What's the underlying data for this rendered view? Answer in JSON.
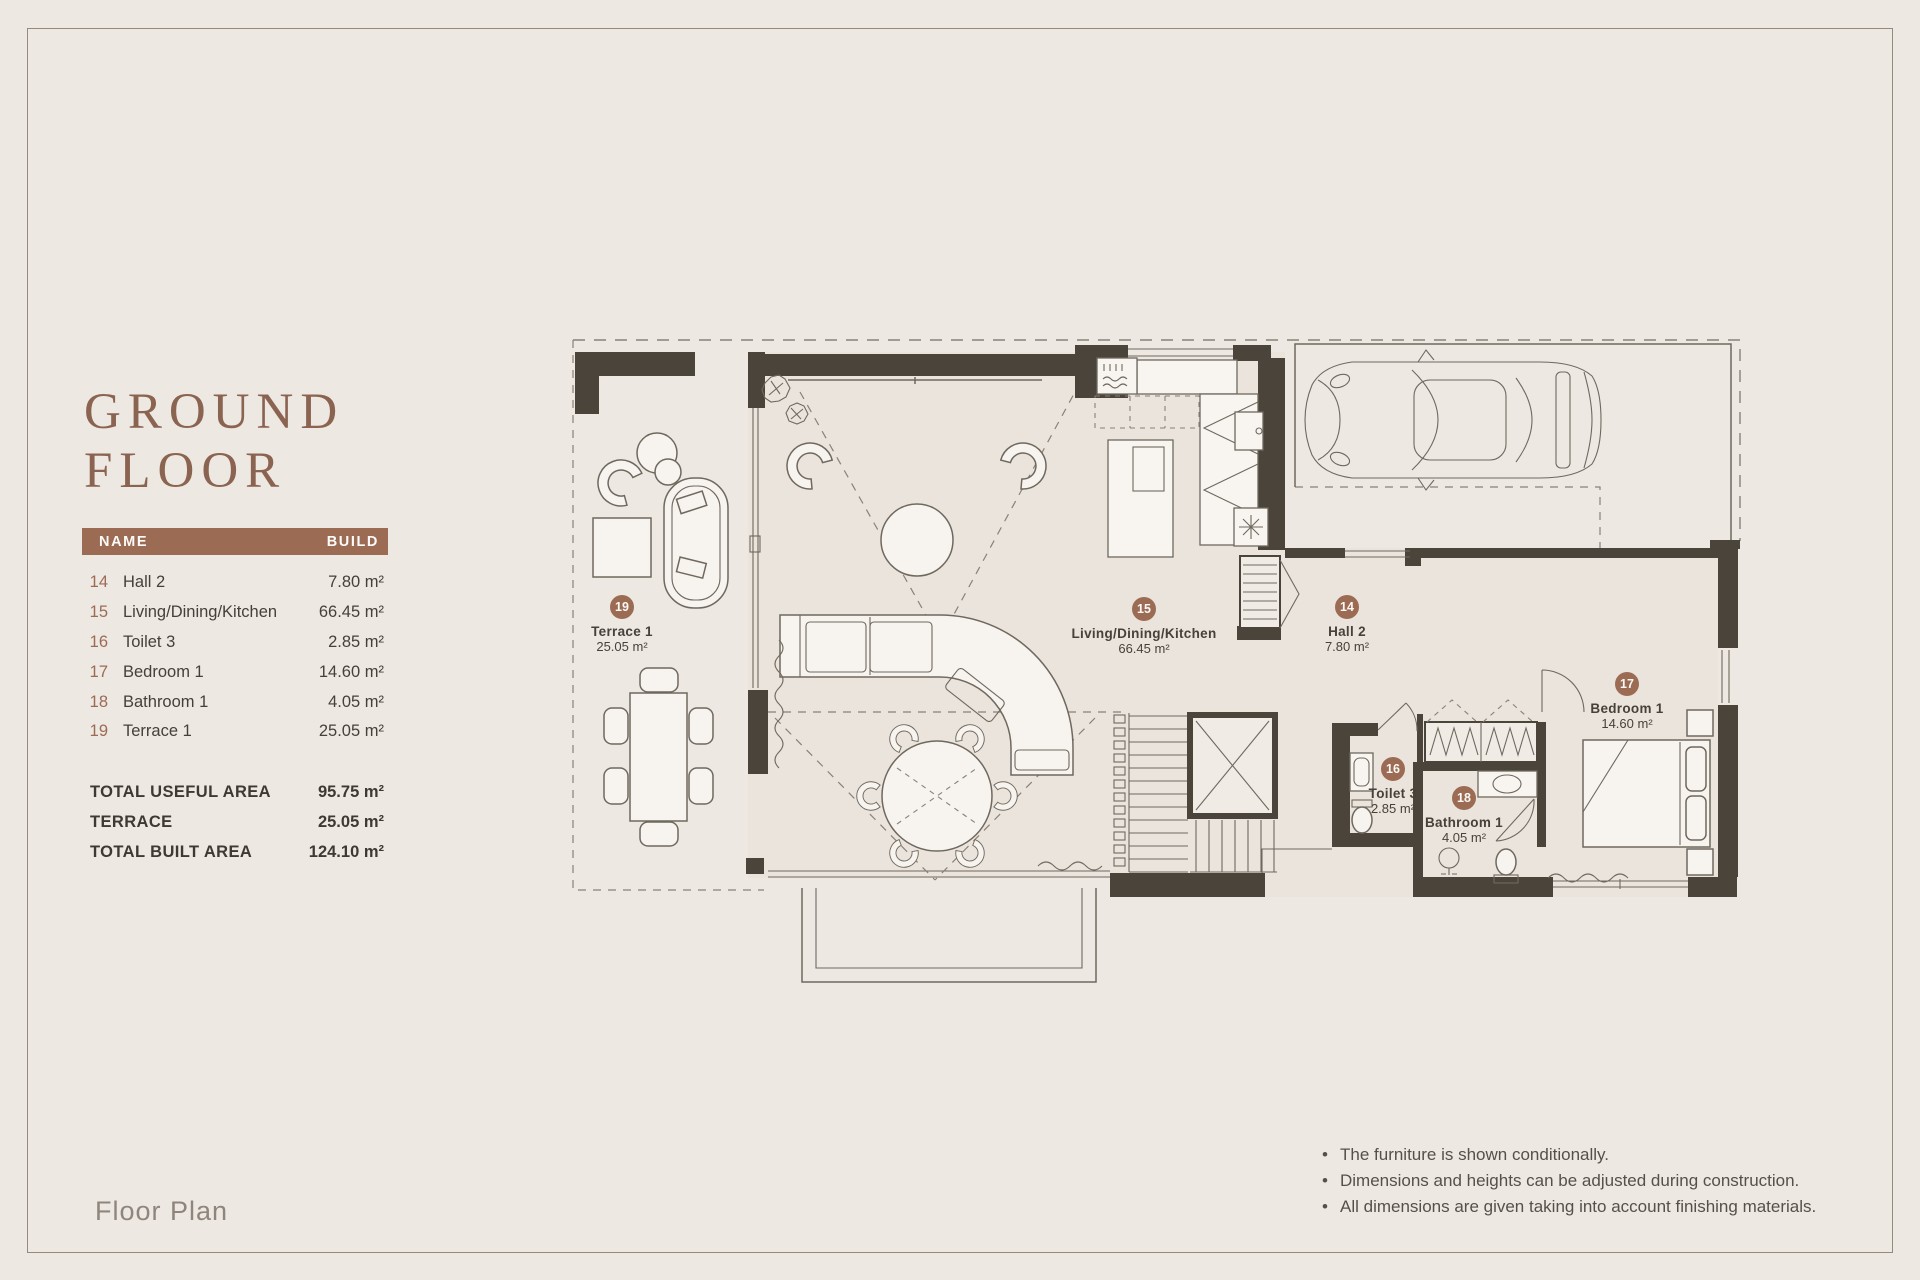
{
  "header": {
    "title_line1": "GROUND",
    "title_line2": "FLOOR"
  },
  "table": {
    "columns": {
      "name": "NAME",
      "build": "BUILD"
    },
    "rows": [
      {
        "num": "14",
        "name": "Hall 2",
        "area": "7.80 m²"
      },
      {
        "num": "15",
        "name": "Living/Dining/Kitchen",
        "area": "66.45 m²"
      },
      {
        "num": "16",
        "name": "Toilet 3",
        "area": "2.85 m²"
      },
      {
        "num": "17",
        "name": "Bedroom 1",
        "area": "14.60 m²"
      },
      {
        "num": "18",
        "name": "Bathroom 1",
        "area": "4.05 m²"
      },
      {
        "num": "19",
        "name": "Terrace 1",
        "area": "25.05 m²"
      }
    ],
    "totals": [
      {
        "label": "TOTAL USEFUL AREA",
        "value": "95.75 m²"
      },
      {
        "label": "TERRACE",
        "value": "25.05 m²"
      },
      {
        "label": "TOTAL BUILT AREA",
        "value": "124.10 m²"
      }
    ]
  },
  "plan": {
    "rooms": [
      {
        "num": "19",
        "name": "Terrace 1",
        "area": "25.05 m²"
      },
      {
        "num": "15",
        "name": "Living/Dining/Kitchen",
        "area": "66.45 m²"
      },
      {
        "num": "14",
        "name": "Hall 2",
        "area": "7.80 m²"
      },
      {
        "num": "17",
        "name": "Bedroom 1",
        "area": "14.60 m²"
      },
      {
        "num": "16",
        "name": "Toilet 3",
        "area": "2.85 m²"
      },
      {
        "num": "18",
        "name": "Bathroom 1",
        "area": "4.05 m²"
      }
    ],
    "badge_color": "#9C6B54",
    "wall_color": "#4B443B"
  },
  "footer": {
    "caption": "Floor Plan"
  },
  "notes": [
    "The furniture is shown conditionally.",
    "Dimensions and heights can be adjusted during construction.",
    "All dimensions are given taking into account finishing materials."
  ]
}
